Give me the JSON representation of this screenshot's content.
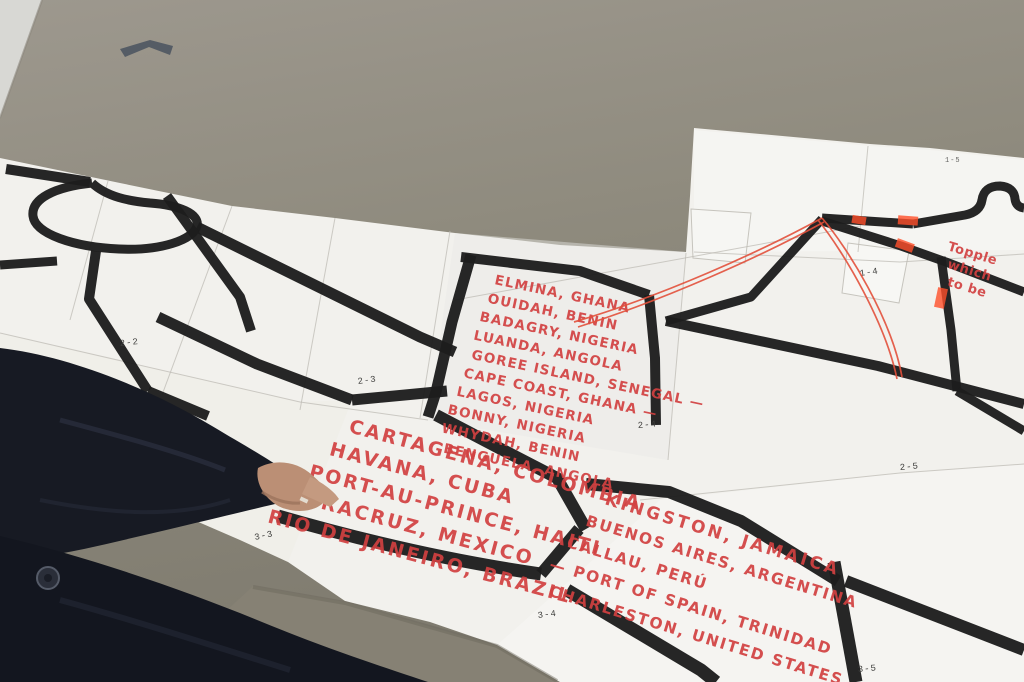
{
  "colors": {
    "floor": "#918c80",
    "wall": "#d8d8d4",
    "paper": "#f2f1ed",
    "marker_black": "#1d1d1d",
    "marker_red": "#d24141",
    "thread_red": "#e2503b",
    "highlighter_orange": "#ff4f2a",
    "clothing_navy": "#171a23",
    "skin": "#bb8f75"
  },
  "map": {
    "tile_labels": [
      "2-2",
      "2-3",
      "2-4",
      "2-5",
      "3-3",
      "3-4",
      "3-5",
      "1-4",
      "1-5"
    ],
    "port_lists": {
      "africa": {
        "lines": [
          "ELMINA, GHANA",
          "OUIDAH, BENIN",
          "BADAGRY, NIGERIA",
          "LUANDA, ANGOLA",
          "GOREE ISLAND, SENEGAL —",
          "CAPE COAST, GHANA —",
          "LAGOS, NIGERIA",
          "BONNY, NIGERIA",
          "WHYDAH, BENIN",
          "BENGUELA, ANGOLA"
        ]
      },
      "caribbean_south_america": {
        "lines": [
          "CARTAGENA, COLOMBIA",
          "HAVANA, CUBA",
          "PORT-AU-PRINCE, HAITI",
          "VERACRUZ, MEXICO",
          "RIO DE JANEIRO, BRAZIL"
        ]
      },
      "americas_atlantic": {
        "lines": [
          "KINGSTON, JAMAICA",
          "BUENOS AIRES, ARGENTINA",
          "CALLAU, PERÚ",
          "— PORT OF SPAIN, TRINIDAD",
          "CHARLESTON, UNITED STATES"
        ]
      }
    },
    "handwritten_note": {
      "lines": [
        "Topple",
        "which",
        "to be"
      ]
    }
  }
}
